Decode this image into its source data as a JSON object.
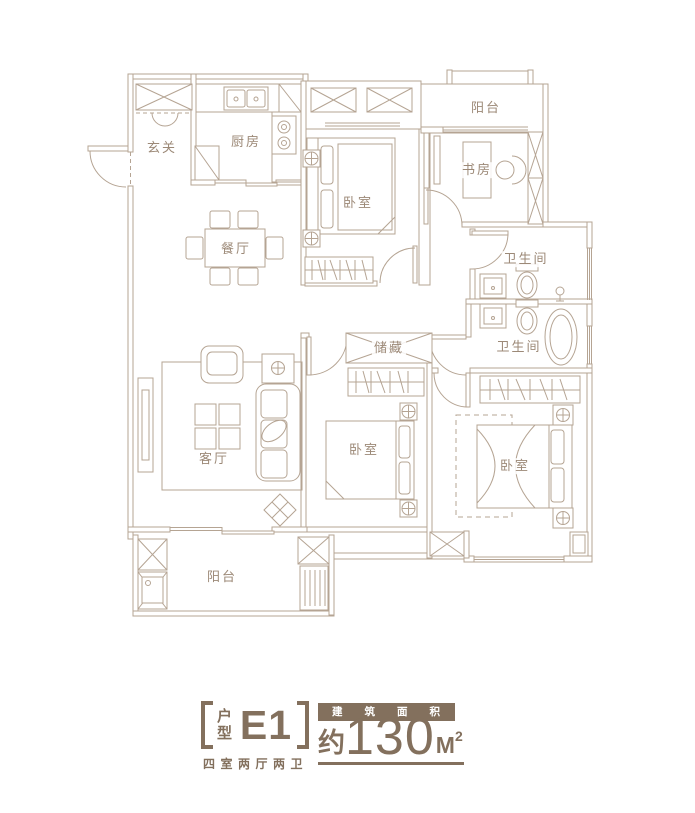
{
  "rooms": {
    "entry": {
      "label": "玄关"
    },
    "kitchen": {
      "label": "厨房"
    },
    "bedroom_top": {
      "label": "卧室"
    },
    "balcony_top": {
      "label": "阳台"
    },
    "study": {
      "label": "书房"
    },
    "bathroom_upper": {
      "label": "卫生间"
    },
    "bathroom_lower": {
      "label": "卫生间"
    },
    "dining": {
      "label": "餐厅"
    },
    "storage": {
      "label": "储藏"
    },
    "living": {
      "label": "客厅"
    },
    "bedroom_middle": {
      "label": "卧室"
    },
    "bedroom_master": {
      "label": "卧室"
    },
    "balcony_bottom": {
      "label": "阳台"
    }
  },
  "legend": {
    "type_char_top": "户",
    "type_char_bottom": "型",
    "type_code": "E1",
    "layout_description": "四室两厅两卫",
    "area_band_label": "建筑面积",
    "area_prefix": "约",
    "area_value": "130",
    "area_unit": "M",
    "area_superscript": "2"
  },
  "colors": {
    "line": "#b5a493",
    "text": "#9c8977",
    "accent": "#83705d",
    "band_text": "#ffffff"
  }
}
